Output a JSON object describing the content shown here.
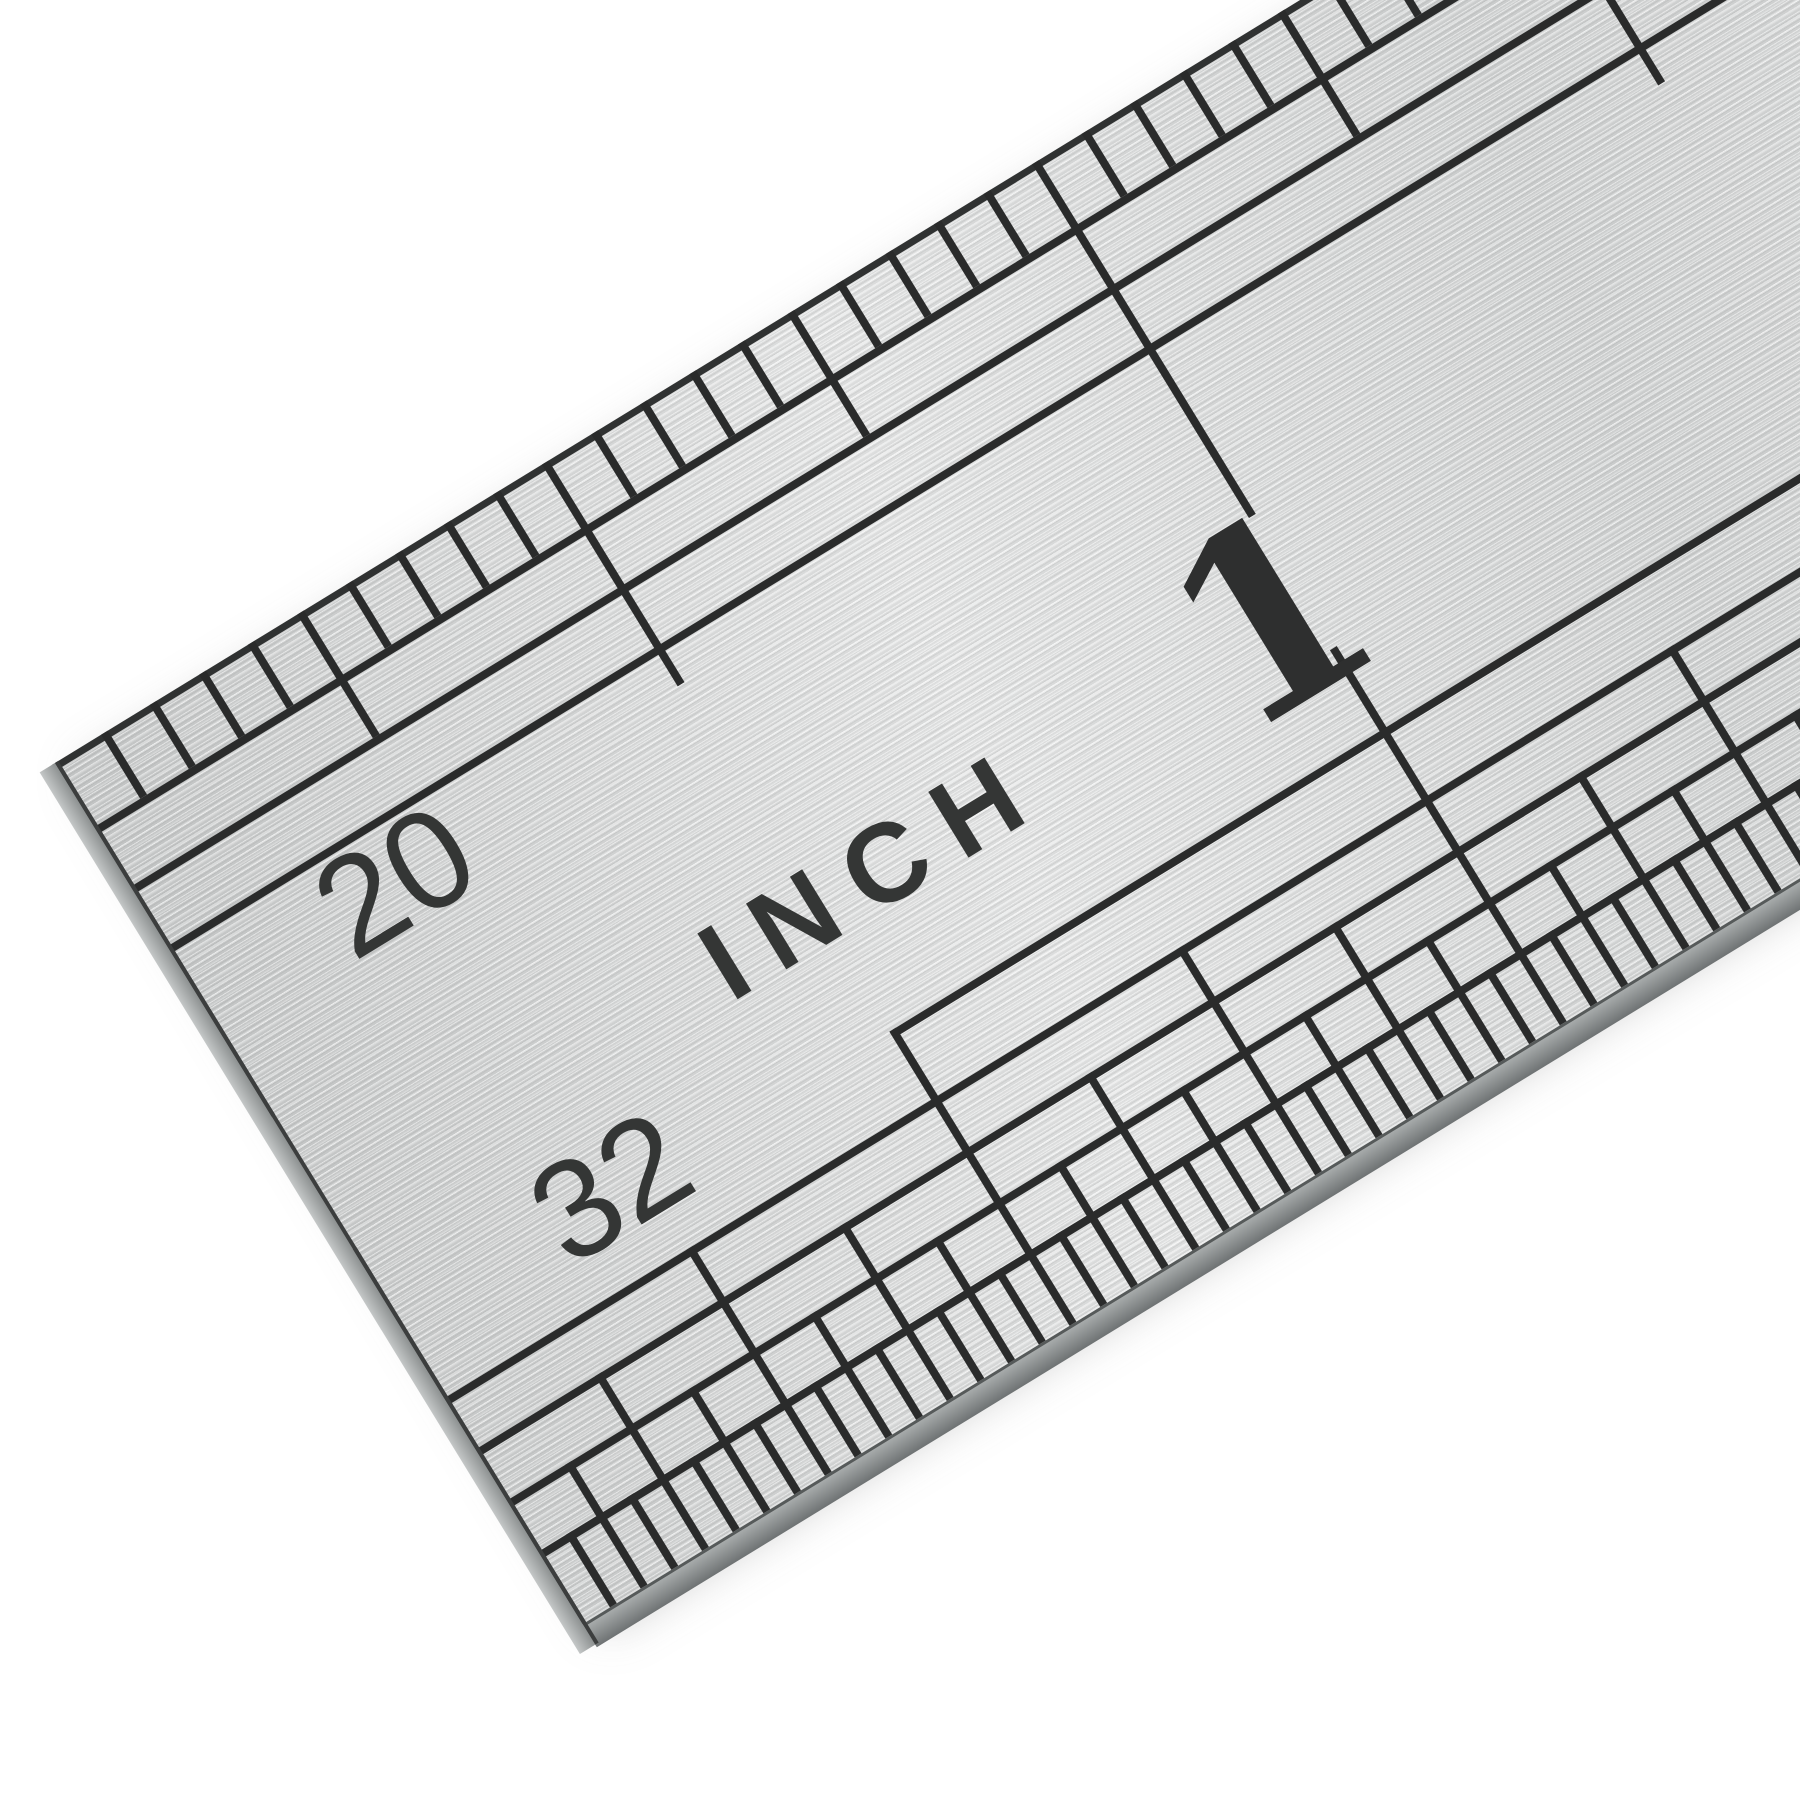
{
  "photo": {
    "subject": "close-up of a stainless steel ruler end, rotated diagonally on white background",
    "background_color": "#ffffff",
    "metal_color": "#d5d7d7",
    "marking_color": "#2a2b2b",
    "edge_color": "#6e7273"
  },
  "ruler": {
    "unit_label": "INCH",
    "inch_number": "1",
    "top_scale": {
      "label": "20",
      "divisions_per_inch": 20
    },
    "bottom_scale": {
      "label": "32",
      "divisions_per_inch": 32
    }
  }
}
